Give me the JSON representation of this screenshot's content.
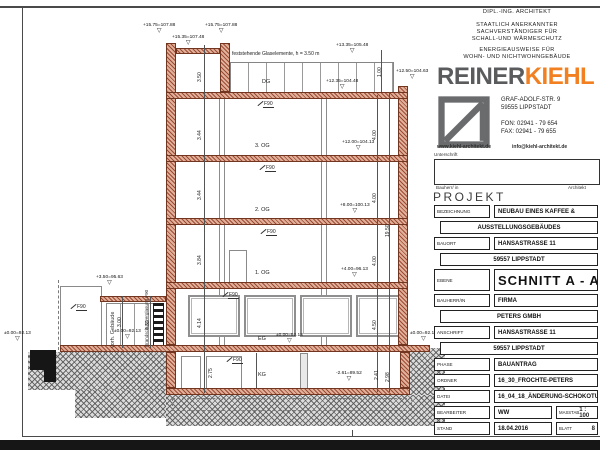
{
  "colors": {
    "wall_hatch": "#9e4b33",
    "logo_gray": "#5a5b5d",
    "logo_orange": "#f28021",
    "ground_gray": "#8a8a8a"
  },
  "sheet": {
    "header": {
      "line1": "DIPL.-ING. ARCHITEKT",
      "line2": "STAATLICH ANERKANNTER",
      "line3": "SACHVERSTÄNDIGER FÜR",
      "line4": "SCHALL-UND WÄRMESCHUTZ",
      "line5": "ENERGIEAUSWEISE FÜR",
      "line6": "WOHN- UND NICHTWOHNGEBÄUDE"
    },
    "logo": {
      "part1": "REINER",
      "part2": "KIEHL"
    },
    "contact": {
      "street": "GRAF-ADOLF-STR. 9",
      "city": "59555 LIPPSTADT",
      "fon": "FON: 02941 - 79 654",
      "fax": "FAX: 02941 - 79 655",
      "web": "www.kiehl-architekt.de",
      "email": "info@kiehl-architekt.de"
    },
    "signature": {
      "title": "Unterschrift",
      "left": "Bauherr/ in",
      "right": "Architekt"
    },
    "project_heading": "PROJEKT",
    "tb": {
      "bezeichnung_label": "BEZEICHNUNG",
      "bezeichnung_1": "NEUBAU EINES KAFFEE &",
      "bezeichnung_2": "AUSSTELLUNGSGEBÄUDES",
      "bauort_label": "BAUORT",
      "bauort_1": "HANSASTRASSE 11",
      "bauort_2": "59557 LIPPSTADT",
      "ebene_label": "EBENE",
      "ebene_value": "SCHNITT A - A",
      "bauherr_label": "BAUHERR/IN",
      "bauherr_1": "FIRMA",
      "bauherr_2": "PETERS GMBH",
      "anschrift_label": "ANSCHRIFT",
      "anschrift_1": "HANSASTRASSE 11",
      "anschrift_2": "59557 LIPPSTADT",
      "phase_label": "PHASE",
      "phase_value": "BAUANTRAG",
      "ordner_label": "ORDNER",
      "ordner_value": "16_30_FROCHTE-PETERS",
      "datei_label": "DATEI",
      "datei_value": "16_04_18_ÄNDERUNG-SCHOKOTURM.S1",
      "bearbeiter_label": "BEARBEITER",
      "bearbeiter_value": "WW",
      "masstab_label": "MASSTAB",
      "masstab_value": "1 : 100",
      "stand_label": "STAND",
      "stand_value": "18.04.2016",
      "blatt_label": "BLATT",
      "blatt_value": "8"
    }
  },
  "drawing": {
    "glass_note": "feststehende Glaselemente, h = 3.50 m",
    "floors": {
      "dg": "DG",
      "og3": "3. OG",
      "og2": "2. OG",
      "og1": "1. OG",
      "eg": "EG",
      "kg": "KG"
    },
    "f90": "F90",
    "existing_building": "vorh. Gebäude",
    "fire_glazing": "Brandschutzverglasung F90",
    "levels": {
      "top_left": "+15.75=107.88",
      "top_mid": "+15.35=107.48",
      "top_right": "+15.75=107.88",
      "dg_top": "+13.35=105.48",
      "dg_deck": "+12.35=104.48",
      "parapet_right": "+12.50=104.63",
      "og3": "+12.00=104.13",
      "og2": "+8.00=100.13",
      "og1": "+4.00=96.13",
      "eg": "±0.00=92.13",
      "kg": "-2.61=89.52",
      "left_ground": "±0.00=92.13",
      "annex_roof": "+3.50=95.63",
      "annex_floor": "±0.00=92.13",
      "right_ground": "±0.00=92.13"
    },
    "dims": {
      "glass": "1.00",
      "dg": "3.50",
      "og3": "3.44",
      "og2": "3.44",
      "og1": "3.84",
      "eg": "4.14",
      "kg": "2.75",
      "r1": "4.00",
      "r2": "4.00",
      "r3": "4.00",
      "r4": "4.50",
      "total": "19.50",
      "kg_a": "2.41",
      "kg_b": "2.98",
      "annex_a": "3.00",
      "annex_b": "4.32"
    }
  }
}
